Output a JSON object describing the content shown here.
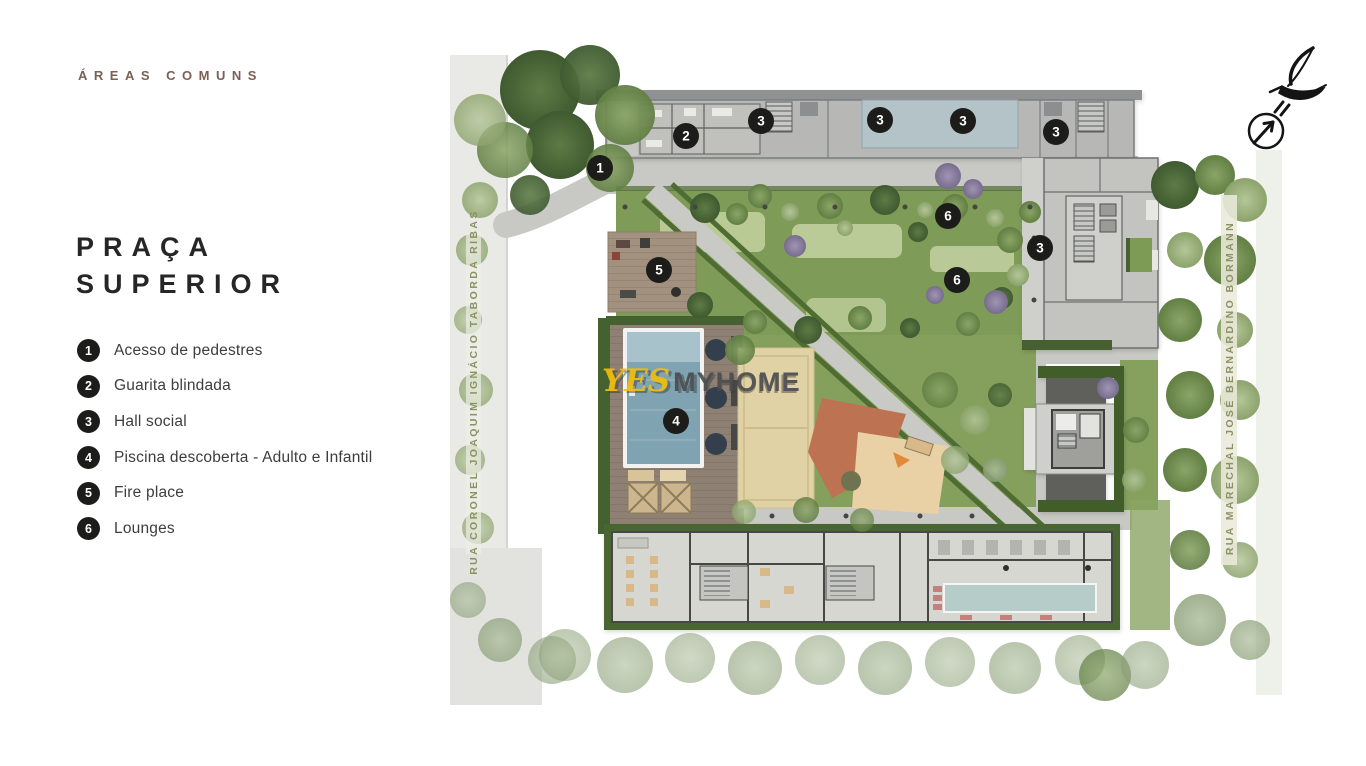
{
  "slide": {
    "eyebrow": "ÁREAS COMUNS",
    "title": {
      "line1": "PRAÇA",
      "line2": "SUPERIOR"
    },
    "legend": [
      {
        "number": "1",
        "label": "Acesso de pedestres"
      },
      {
        "number": "2",
        "label": "Guarita blindada"
      },
      {
        "number": "3",
        "label": "Hall social"
      },
      {
        "number": "4",
        "label": "Piscina descoberta - Adulto e Infantil"
      },
      {
        "number": "5",
        "label": "Fire place"
      },
      {
        "number": "6",
        "label": "Lounges"
      }
    ]
  },
  "plan": {
    "streets": {
      "left": "RUA CORONEL JOAQUIM IGNÁCIO TABORDA RIBAS",
      "right": "RUA MARECHAL JOSÉ BERNARDINO BORMANN"
    },
    "watermark": {
      "brand_yes": "YES",
      "brand_myhome": "MYHOME"
    },
    "markers": [
      {
        "n": "1",
        "feature": "acesso-de-pedestres"
      },
      {
        "n": "2",
        "feature": "guarita-blindada"
      },
      {
        "n": "3",
        "feature": "hall-social"
      },
      {
        "n": "3",
        "feature": "hall-social"
      },
      {
        "n": "3",
        "feature": "hall-social"
      },
      {
        "n": "3",
        "feature": "hall-social"
      },
      {
        "n": "3",
        "feature": "hall-social"
      },
      {
        "n": "6",
        "feature": "lounge"
      },
      {
        "n": "6",
        "feature": "lounge"
      },
      {
        "n": "5",
        "feature": "fire-place"
      },
      {
        "n": "4",
        "feature": "piscina-descoberta"
      }
    ]
  },
  "icons": {
    "logo": "bird-sketch",
    "compass": "north-arrow"
  },
  "colors": {
    "badge": "#1c1c1a",
    "lawn": "#7e9b57",
    "water": "#7fa3b1",
    "deck": "#8e8173",
    "street_label": "#8b9164",
    "eyebrow": "#7b5f56",
    "title": "#262626",
    "watermark_yellow": "#f0be0a",
    "watermark_gray": "#4b4c50"
  }
}
